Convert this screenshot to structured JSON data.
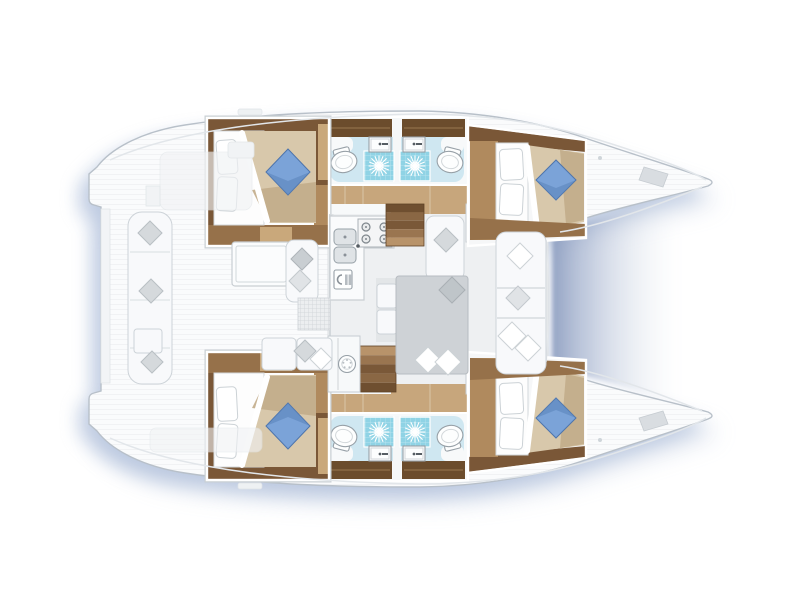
{
  "scene": {
    "subject": "Catamaran yacht interior floor plan, top-down view, bows to the right",
    "areas": {
      "cockpit": "aft cockpit with long bench, throw pillows, table, chaise and mat",
      "saloon": "central saloon with galley, forward lounge seat, dining table and front bench",
      "galley": "L-shaped counter with double sink, four-burner stove and fridge",
      "hulls": "two mirrored hulls, each with an aft cabin, two bathrooms and a bow cabin",
      "bathrooms": "each with toilet, washbasin, dark wood vanity and tiled shower with sunburst drain",
      "trampoline": "shaded gap between the two bow tips forward of the saloon"
    },
    "counts": {
      "cabins": 4,
      "double_beds": 4,
      "blue_bed_pillows": 4,
      "bathrooms": 4,
      "showers": 4,
      "toilets": 4,
      "bathroom_sinks": 4,
      "galley_burners": 4,
      "stairways": 2,
      "companionway_step_pairs": 4
    }
  },
  "colors": {
    "deck": "#fafbfc",
    "deck_stroke": "#b8c0c9",
    "deck_line": "#e2e6ea",
    "shadow_blue": "#8fa5cc",
    "trampoline_dark": "#8496bb",
    "wood_frame": "#7a5737",
    "wood_dark": "#6b4c2c",
    "wood_mid": "#b08a5e",
    "wood_light": "#c9a87b",
    "wood_corridor": "#c7a67c",
    "duvet": "#d8c8ab",
    "duvet_dark": "#c2ac8a",
    "mattress": "#fdfdfd",
    "pillow_blue": "#7ba3d8",
    "pillow_blue_dark": "#5c86bc",
    "bath_floor": "#cfe7f1",
    "shower_tile": "#8fd3e5",
    "saloon_floor": "#eef0f2",
    "table_gray": "#ced2d6",
    "cushion": "#f8f9fb",
    "cushion_stroke": "#cdd3d8",
    "pillow_gray": "#d5d9dc",
    "step_blue": "#8db1e1",
    "step_blue_dark": "#30508e",
    "stair_dark": "#6f4f30",
    "stair_light": "#9a7550",
    "fixture_stroke": "#97a0a7"
  }
}
